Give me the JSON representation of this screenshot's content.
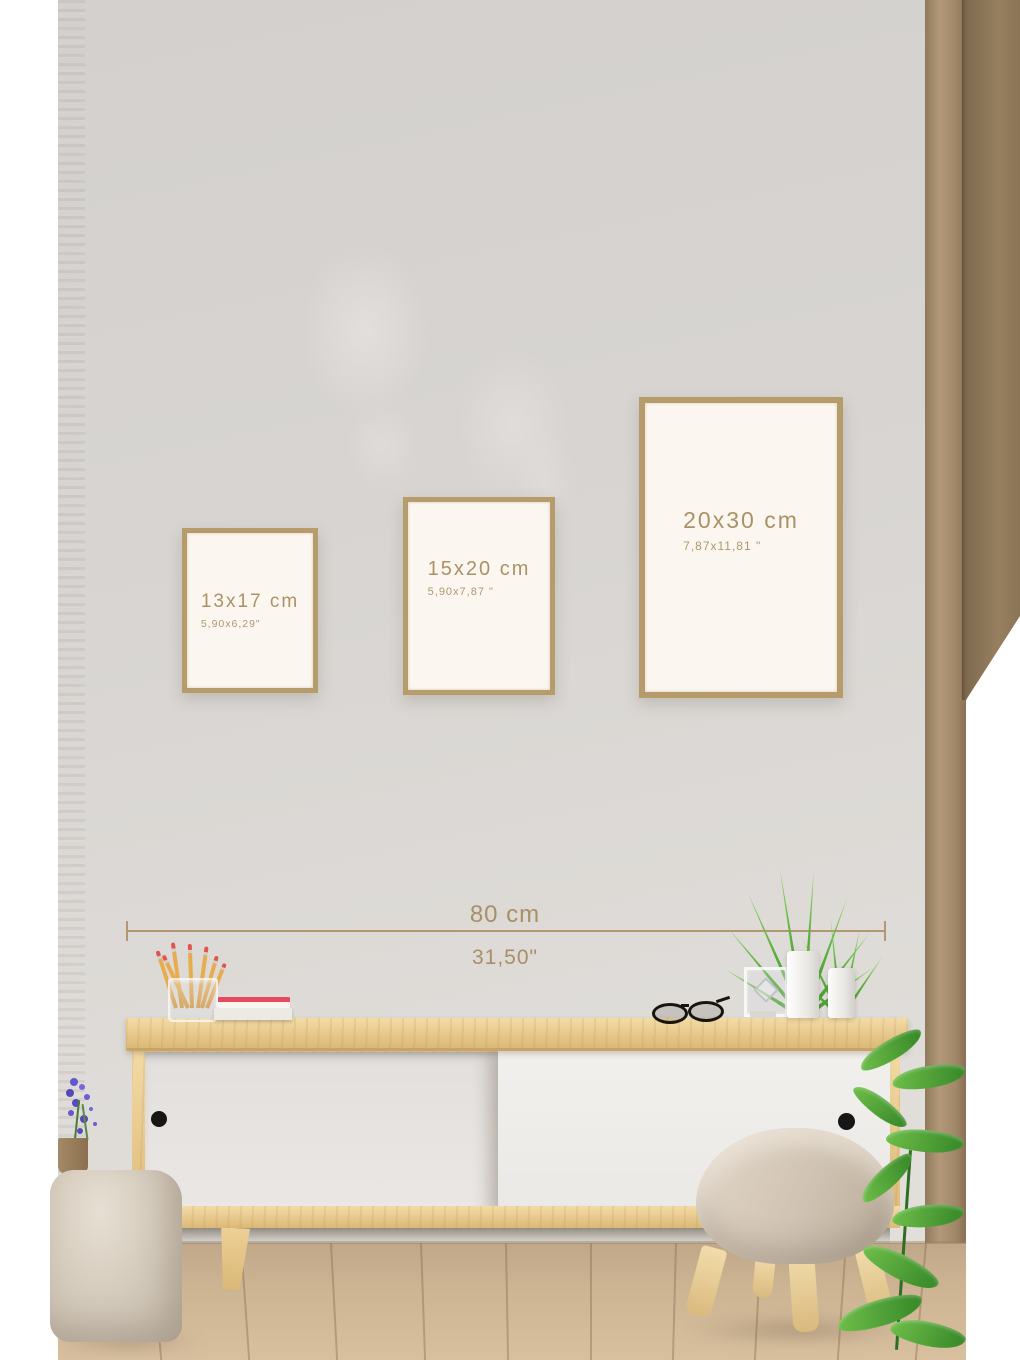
{
  "frames": {
    "items": [
      {
        "size_cm": "13x17 cm",
        "size_inch": "5,90x6,29\""
      },
      {
        "size_cm": "15x20 cm",
        "size_inch": "5,90x7,87 \""
      },
      {
        "size_cm": "20x30 cm",
        "size_inch": "7,87x11,81 \""
      }
    ]
  },
  "measurement": {
    "cm": "80 cm",
    "inch": "31,50\""
  },
  "colors": {
    "frame_wood": "#b79c6b",
    "frame_paper": "#fbf7f0",
    "label_text": "#ab9166",
    "measure_line": "#b29770",
    "wall_gray": "#d7d4d2",
    "cabinet_wood": "#e8c98e",
    "door_white": "#efedea",
    "floor_wood": "#cdb392",
    "plant_green": "#5cb23e",
    "pouf_beige": "#d4cabb"
  }
}
